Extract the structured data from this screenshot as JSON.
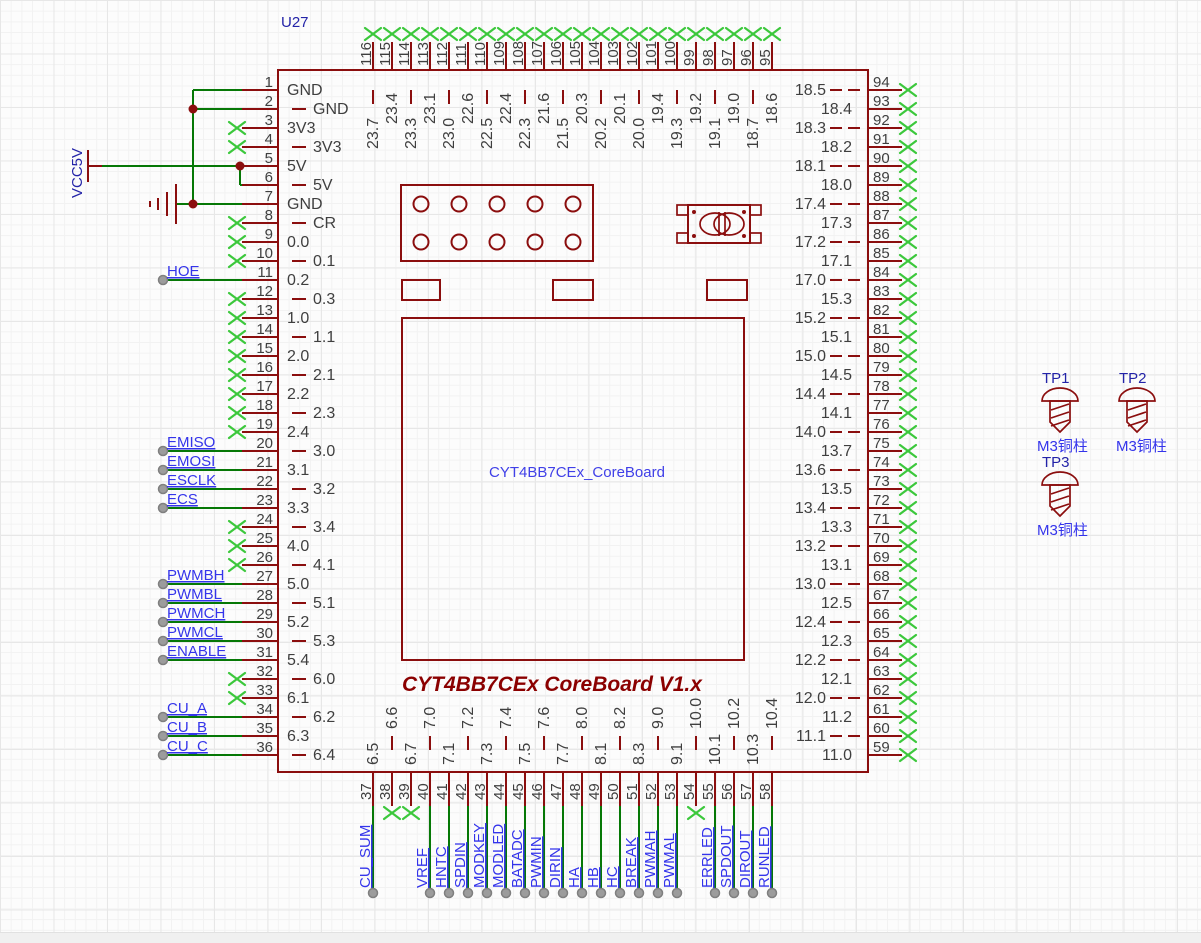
{
  "designator": "U27",
  "component_name": "CYT4BB7CEx_CoreBoard",
  "board_title": "CYT4BB7CEx CoreBoard V1.x",
  "power": {
    "vcc_label": "VCC5V"
  },
  "colors": {
    "symbol_red": "#8B0E0E",
    "wire_green": "#067806",
    "no_connect_green": "#3CC83C",
    "net_label_blue": "#3434EB",
    "designator_blue": "#2323A8",
    "title_red": "#8B0000"
  },
  "left_pins": [
    {
      "num": "1",
      "name": "GND"
    },
    {
      "num": "2",
      "name": "GND"
    },
    {
      "num": "3",
      "name": "3V3",
      "nc": true
    },
    {
      "num": "4",
      "name": "3V3",
      "nc": true
    },
    {
      "num": "5",
      "name": "5V"
    },
    {
      "num": "6",
      "name": "5V"
    },
    {
      "num": "7",
      "name": "GND"
    },
    {
      "num": "8",
      "name": "CR",
      "nc": true
    },
    {
      "num": "9",
      "name": "0.0",
      "nc": true
    },
    {
      "num": "10",
      "name": "0.1",
      "nc": true
    },
    {
      "num": "11",
      "name": "0.2",
      "net": "HOE"
    },
    {
      "num": "12",
      "name": "0.3",
      "nc": true
    },
    {
      "num": "13",
      "name": "1.0",
      "nc": true
    },
    {
      "num": "14",
      "name": "1.1",
      "nc": true
    },
    {
      "num": "15",
      "name": "2.0",
      "nc": true
    },
    {
      "num": "16",
      "name": "2.1",
      "nc": true
    },
    {
      "num": "17",
      "name": "2.2",
      "nc": true
    },
    {
      "num": "18",
      "name": "2.3",
      "nc": true
    },
    {
      "num": "19",
      "name": "2.4",
      "nc": true
    },
    {
      "num": "20",
      "name": "3.0",
      "net": "EMISO"
    },
    {
      "num": "21",
      "name": "3.1",
      "net": "EMOSI"
    },
    {
      "num": "22",
      "name": "3.2",
      "net": "ESCLK"
    },
    {
      "num": "23",
      "name": "3.3",
      "net": "ECS"
    },
    {
      "num": "24",
      "name": "3.4",
      "nc": true
    },
    {
      "num": "25",
      "name": "4.0",
      "nc": true
    },
    {
      "num": "26",
      "name": "4.1",
      "nc": true
    },
    {
      "num": "27",
      "name": "5.0",
      "net": "PWMBH"
    },
    {
      "num": "28",
      "name": "5.1",
      "net": "PWMBL"
    },
    {
      "num": "29",
      "name": "5.2",
      "net": "PWMCH"
    },
    {
      "num": "30",
      "name": "5.3",
      "net": "PWMCL"
    },
    {
      "num": "31",
      "name": "5.4",
      "net": "ENABLE"
    },
    {
      "num": "32",
      "name": "6.0",
      "nc": true
    },
    {
      "num": "33",
      "name": "6.1",
      "nc": true
    },
    {
      "num": "34",
      "name": "6.2",
      "net": "CU_A"
    },
    {
      "num": "35",
      "name": "6.3",
      "net": "CU_B"
    },
    {
      "num": "36",
      "name": "6.4",
      "net": "CU_C"
    }
  ],
  "bottom_pins": [
    {
      "num": "37",
      "name": "6.5",
      "net": "CU_SUM"
    },
    {
      "num": "38",
      "name": "6.6",
      "nc": true
    },
    {
      "num": "39",
      "name": "6.7",
      "nc": true
    },
    {
      "num": "40",
      "name": "7.0",
      "net": "VREF"
    },
    {
      "num": "41",
      "name": "7.1",
      "net": "HNTC"
    },
    {
      "num": "42",
      "name": "7.2",
      "net": "SPDIN"
    },
    {
      "num": "43",
      "name": "7.3",
      "net": "MODKEY"
    },
    {
      "num": "44",
      "name": "7.4",
      "net": "MODLED"
    },
    {
      "num": "45",
      "name": "7.5",
      "net": "BATADC"
    },
    {
      "num": "46",
      "name": "7.6",
      "net": "PWMIN"
    },
    {
      "num": "47",
      "name": "7.7",
      "net": "DIRIN"
    },
    {
      "num": "48",
      "name": "8.0",
      "net": "HA"
    },
    {
      "num": "49",
      "name": "8.1",
      "net": "HB"
    },
    {
      "num": "50",
      "name": "8.2",
      "net": "HC"
    },
    {
      "num": "51",
      "name": "8.3",
      "net": "BREAK"
    },
    {
      "num": "52",
      "name": "9.0",
      "net": "PWMAH"
    },
    {
      "num": "53",
      "name": "9.1",
      "net": "PWMAL"
    },
    {
      "num": "54",
      "name": "10.0",
      "nc": true
    },
    {
      "num": "55",
      "name": "10.1",
      "net": "ERRLED"
    },
    {
      "num": "56",
      "name": "10.2",
      "net": "SPDOUT"
    },
    {
      "num": "57",
      "name": "10.3",
      "net": "DIROUT"
    },
    {
      "num": "58",
      "name": "10.4",
      "net": "RUNLED"
    }
  ],
  "top_pins": [
    {
      "num": "116",
      "name": "23.7",
      "nc": true
    },
    {
      "num": "115",
      "name": "23.4",
      "nc": true
    },
    {
      "num": "114",
      "name": "23.3",
      "nc": true
    },
    {
      "num": "113",
      "name": "23.1",
      "nc": true
    },
    {
      "num": "112",
      "name": "23.0",
      "nc": true
    },
    {
      "num": "111",
      "name": "22.6",
      "nc": true
    },
    {
      "num": "110",
      "name": "22.5",
      "nc": true
    },
    {
      "num": "109",
      "name": "22.4",
      "nc": true
    },
    {
      "num": "108",
      "name": "22.3",
      "nc": true
    },
    {
      "num": "107",
      "name": "21.6",
      "nc": true
    },
    {
      "num": "106",
      "name": "21.5",
      "nc": true
    },
    {
      "num": "105",
      "name": "20.3",
      "nc": true
    },
    {
      "num": "104",
      "name": "20.2",
      "nc": true
    },
    {
      "num": "103",
      "name": "20.1",
      "nc": true
    },
    {
      "num": "102",
      "name": "20.0",
      "nc": true
    },
    {
      "num": "101",
      "name": "19.4",
      "nc": true
    },
    {
      "num": "100",
      "name": "19.3",
      "nc": true
    },
    {
      "num": "99",
      "name": "19.2",
      "nc": true
    },
    {
      "num": "98",
      "name": "19.1",
      "nc": true
    },
    {
      "num": "97",
      "name": "19.0",
      "nc": true
    },
    {
      "num": "96",
      "name": "18.7",
      "nc": true
    },
    {
      "num": "95",
      "name": "18.6",
      "nc": true
    }
  ],
  "right_pins": [
    {
      "num": "94",
      "name": "18.5",
      "nc": true
    },
    {
      "num": "93",
      "name": "18.4",
      "nc": true
    },
    {
      "num": "92",
      "name": "18.3",
      "nc": true
    },
    {
      "num": "91",
      "name": "18.2",
      "nc": true
    },
    {
      "num": "90",
      "name": "18.1",
      "nc": true
    },
    {
      "num": "89",
      "name": "18.0",
      "nc": true
    },
    {
      "num": "88",
      "name": "17.4",
      "nc": true
    },
    {
      "num": "87",
      "name": "17.3",
      "nc": true
    },
    {
      "num": "86",
      "name": "17.2",
      "nc": true
    },
    {
      "num": "85",
      "name": "17.1",
      "nc": true
    },
    {
      "num": "84",
      "name": "17.0",
      "nc": true
    },
    {
      "num": "83",
      "name": "15.3",
      "nc": true
    },
    {
      "num": "82",
      "name": "15.2",
      "nc": true
    },
    {
      "num": "81",
      "name": "15.1",
      "nc": true
    },
    {
      "num": "80",
      "name": "15.0",
      "nc": true
    },
    {
      "num": "79",
      "name": "14.5",
      "nc": true
    },
    {
      "num": "78",
      "name": "14.4",
      "nc": true
    },
    {
      "num": "77",
      "name": "14.1",
      "nc": true
    },
    {
      "num": "76",
      "name": "14.0",
      "nc": true
    },
    {
      "num": "75",
      "name": "13.7",
      "nc": true
    },
    {
      "num": "74",
      "name": "13.6",
      "nc": true
    },
    {
      "num": "73",
      "name": "13.5",
      "nc": true
    },
    {
      "num": "72",
      "name": "13.4",
      "nc": true
    },
    {
      "num": "71",
      "name": "13.3",
      "nc": true
    },
    {
      "num": "70",
      "name": "13.2",
      "nc": true
    },
    {
      "num": "69",
      "name": "13.1",
      "nc": true
    },
    {
      "num": "68",
      "name": "13.0",
      "nc": true
    },
    {
      "num": "67",
      "name": "12.5",
      "nc": true
    },
    {
      "num": "66",
      "name": "12.4",
      "nc": true
    },
    {
      "num": "65",
      "name": "12.3",
      "nc": true
    },
    {
      "num": "64",
      "name": "12.2",
      "nc": true
    },
    {
      "num": "63",
      "name": "12.1",
      "nc": true
    },
    {
      "num": "62",
      "name": "12.0",
      "nc": true
    },
    {
      "num": "61",
      "name": "11.2",
      "nc": true
    },
    {
      "num": "60",
      "name": "11.1",
      "nc": true
    },
    {
      "num": "59",
      "name": "11.0",
      "nc": true
    }
  ],
  "testpoints": [
    {
      "ref": "TP1",
      "label": "M3铜柱"
    },
    {
      "ref": "TP2",
      "label": "M3铜柱"
    },
    {
      "ref": "TP3",
      "label": "M3铜柱"
    }
  ]
}
